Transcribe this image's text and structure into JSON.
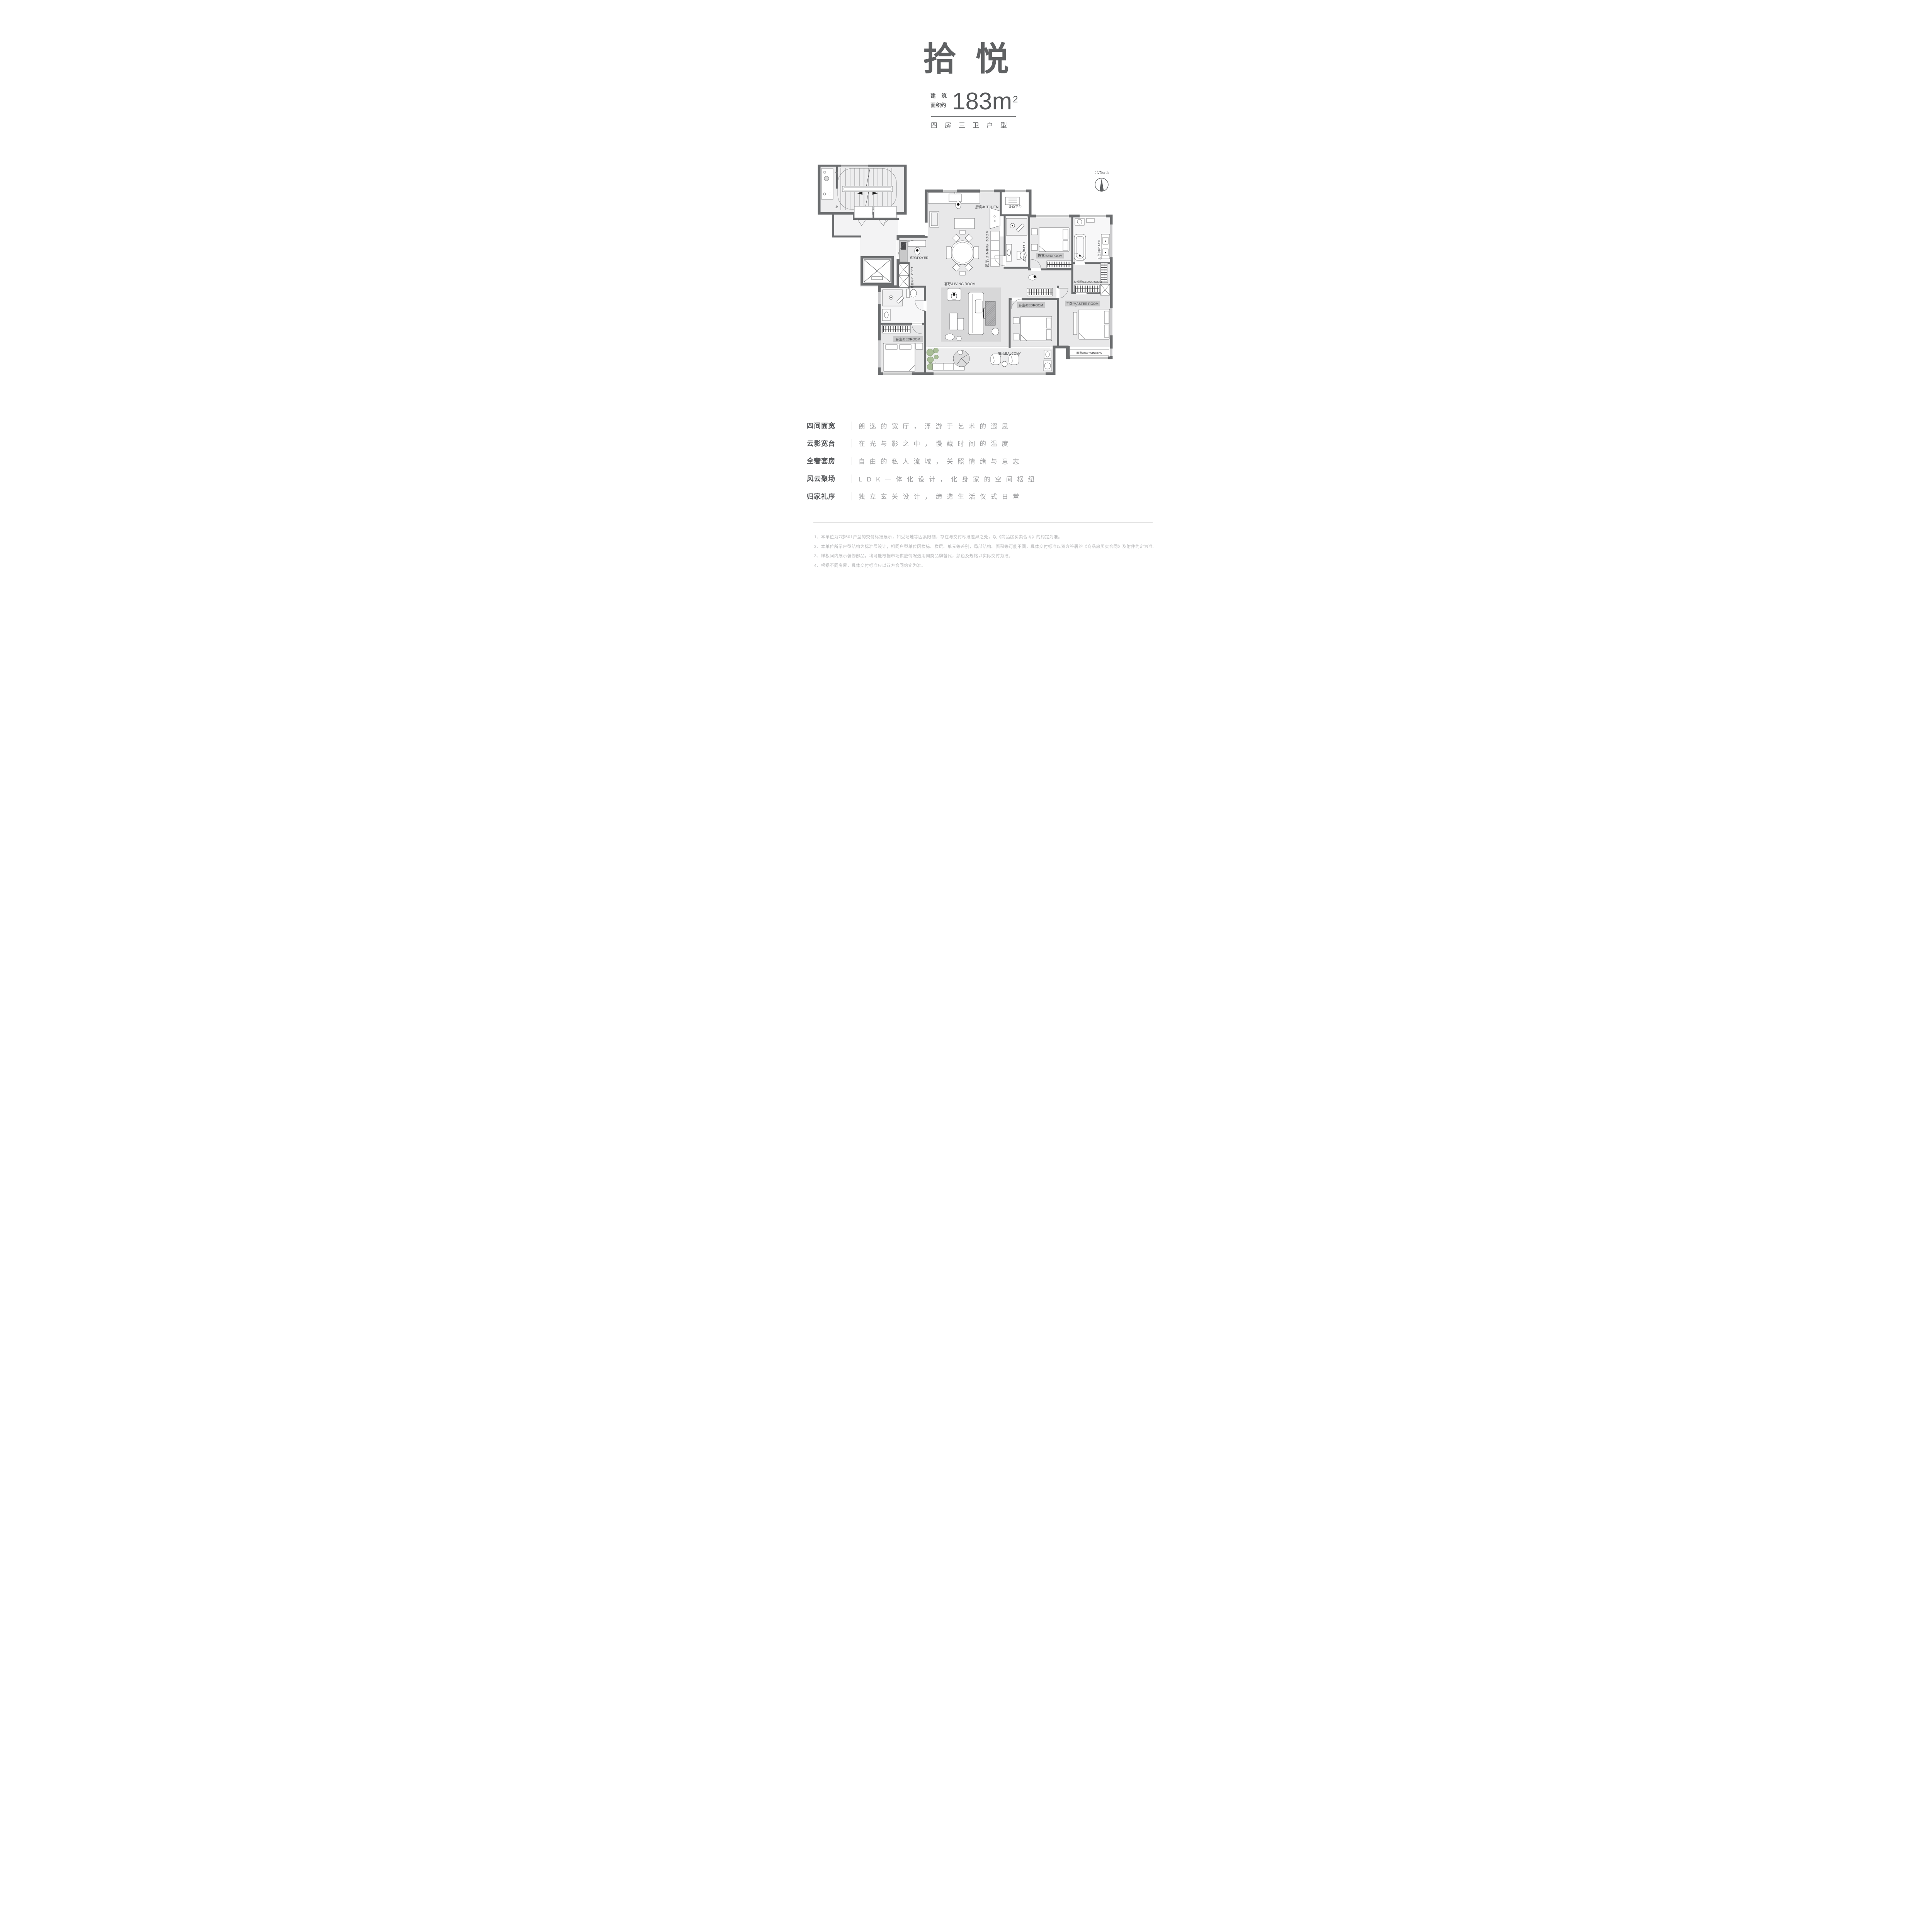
{
  "header": {
    "title": "拾悦",
    "area_prefix_line1_a": "建",
    "area_prefix_line1_b": "筑",
    "area_prefix_line2": "面积约",
    "area_value": "183",
    "area_unit": "m",
    "area_sup": "2",
    "layout_line": "四房三卫户型"
  },
  "plan": {
    "labels": {
      "kitchen": "厨房/KITCHEN",
      "equipment": "设备平台",
      "bath_right": "卫生间/BATH",
      "bath_mid": "卫生间/BATH",
      "bedroom_top": "卧室/BEDROOM",
      "bedroom_mid": "卧室/BEDROOM",
      "bedroom_left": "卧室/BEDROOM",
      "cloakroom": "衣帽间/CLOAKROOM",
      "master": "主卧/MASTER ROOM",
      "living": "客厅/LIVING ROOM",
      "dining": "餐厅/DINING ROOM",
      "foyer": "玄关/FOYER",
      "closet": "储物间/CLOSET",
      "balcony": "阳台/BALCONY",
      "bay_window": "飘窗/BAY WINDOW",
      "stairs_up": "上",
      "stairs_down": "下"
    },
    "north_label": "北/North"
  },
  "features": [
    {
      "label": "四间面宽",
      "text": "朗逸的宽厅，浮游于艺术的遐思"
    },
    {
      "label": "云影宽台",
      "text": "在光与影之中，慢藏时间的温度"
    },
    {
      "label": "全奢套房",
      "text": "自由的私人流域，关照情绪与意志"
    },
    {
      "label": "风云聚场",
      "text": "LDK一体化设计，化身家的空间枢纽"
    },
    {
      "label": "归家礼序",
      "text": "独立玄关设计，缔造生活仪式日常"
    }
  ],
  "footnotes": [
    "1、本单位为7栋501户型的交付标准展示，如受场地等因素限制，存在与交付标准差异之处，以《商品房买卖合同》的约定为准。",
    "2、本单位所示户型结构为标准层设计，相同户型单位因楼栋、楼层、单元等差别，局部结构、面积等可能不同，具体交付标准以双方签署的《商品房买卖合同》及附件约定为准。",
    "3、样板间内展示装修部品，均可能根据市场供应情况选用同类品牌替代，颜色及规格以实际交付为准。",
    "4、根据不同房屋，具体交付标准应以双方合同约定为准。"
  ],
  "colors": {
    "ink": "#5f6163",
    "wall": "#6b6d6f",
    "floor": "#e8e8e9",
    "rug": "#d7d7d8",
    "feature_text": "#9b9c9e",
    "footnote": "#b7b8ba",
    "plant": "#a9bd97"
  }
}
